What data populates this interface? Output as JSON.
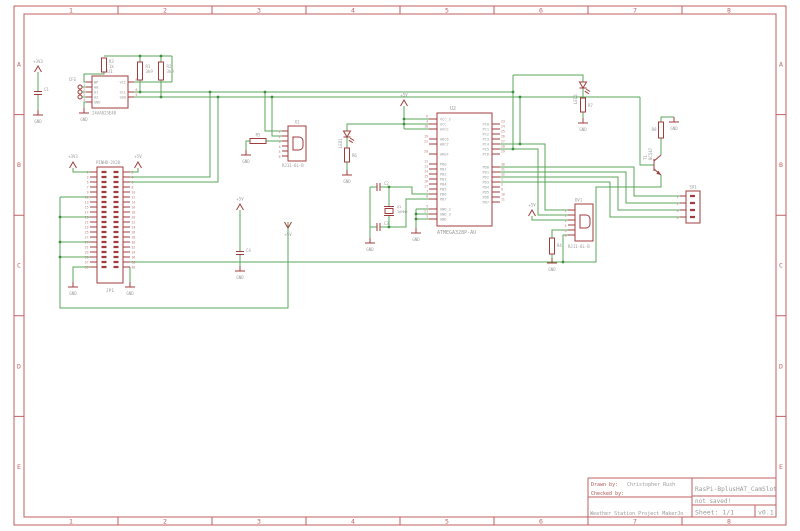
{
  "frame": {
    "columns": [
      "1",
      "2",
      "3",
      "4",
      "5",
      "6",
      "7",
      "8"
    ],
    "rows": [
      "A",
      "B",
      "C",
      "D",
      "E"
    ]
  },
  "title_block": {
    "drawn_by_label": "Drawn by:",
    "drawn_by_value": "Christopher Rush",
    "checked_by_label": "Checked by:",
    "checked_by_value": "",
    "project": "Weather Station Project MakerJo",
    "document_title": "RasPi-BplusHAT_CamSlot",
    "save_status": "not saved!",
    "sheet": "Sheet: 1/1",
    "version": "v0.1"
  },
  "net_labels": {
    "gnd": "GND",
    "p3v3": "+3V3",
    "p5v": "+5V"
  },
  "colors": {
    "wire": "#58a758",
    "symbol": "#a03c3c",
    "frame": "#c06060",
    "label": "#9a9a9a"
  },
  "components": {
    "u1": {
      "ref": "U1",
      "value": "24AA025E48",
      "pins_left": [
        "WP",
        "A0",
        "A1",
        "A2",
        "GND"
      ],
      "pin_numbers_left": [
        "7",
        "1",
        "2",
        "3",
        "4"
      ],
      "pins_right": [
        "VCC",
        "",
        "SCL",
        "SDA"
      ],
      "pin_numbers_right": [
        "8",
        "",
        "6",
        "5"
      ]
    },
    "cfg": {
      "ref": "CFG"
    },
    "c1": {
      "ref": "C1"
    },
    "c2": {
      "ref": "C2"
    },
    "c3": {
      "ref": "C3"
    },
    "c4": {
      "ref": "C4"
    },
    "r1": {
      "ref": "R1",
      "value": "3k9"
    },
    "r2": {
      "ref": "R2",
      "value": "3k9"
    },
    "r3": {
      "ref": "R3",
      "value": "1k"
    },
    "r4": {
      "ref": "R4"
    },
    "r5": {
      "ref": "R5"
    },
    "r6": {
      "ref": "R6"
    },
    "r7": {
      "ref": "R7"
    },
    "r8": {
      "ref": "R8"
    },
    "jp1": {
      "ref": "JP1",
      "value": "PINHD-2X20",
      "pin_numbers_left": [
        "1",
        "3",
        "5",
        "7",
        "9",
        "11",
        "13",
        "15",
        "17",
        "19",
        "21",
        "23",
        "25",
        "27",
        "29",
        "31",
        "33",
        "35",
        "37",
        "39"
      ],
      "pin_numbers_right": [
        "2",
        "4",
        "6",
        "8",
        "10",
        "12",
        "14",
        "16",
        "18",
        "20",
        "22",
        "24",
        "26",
        "28",
        "30",
        "32",
        "34",
        "36",
        "38",
        "40"
      ]
    },
    "x1": {
      "ref": "X1",
      "value": "RJ11-6L-B",
      "pin_numbers": [
        "1",
        "2",
        "3",
        "4",
        "5",
        "6"
      ]
    },
    "dv1": {
      "ref": "DV1",
      "value": "RJ11-6L-B",
      "pin_numbers": [
        "1",
        "2",
        "3",
        "4",
        "5",
        "6"
      ]
    },
    "sv1": {
      "ref": "SV1",
      "pin_numbers": [
        "1",
        "2",
        "3",
        "4"
      ]
    },
    "u2": {
      "ref": "U2",
      "value": "ATMEGA328P-AU",
      "pins_left": [
        "VCC_2",
        "VCC",
        "AVCC",
        "",
        "ADC6",
        "ADC7",
        "",
        "AREF",
        "",
        "PB0",
        "PB1",
        "PB2",
        "PB3",
        "PB4",
        "PB5",
        "PB6",
        "PB7",
        "",
        "GND_2",
        "GND_3",
        "GND"
      ],
      "pin_numbers_left": [
        "6",
        "4",
        "18",
        "",
        "19",
        "22",
        "",
        "20",
        "",
        "12",
        "13",
        "14",
        "15",
        "16",
        "17",
        "7",
        "8",
        "",
        "5",
        "21",
        "3"
      ],
      "pins_right_pc": [
        "PC0",
        "PC1",
        "PC2",
        "PC3",
        "PC4",
        "PC5",
        "PC6"
      ],
      "pin_numbers_right_pc": [
        "23",
        "24",
        "25",
        "26",
        "27",
        "28",
        "29"
      ],
      "pins_right_pd": [
        "PD0",
        "PD1",
        "PD2",
        "PD3",
        "PD4",
        "PD5",
        "PD6",
        "PD7"
      ],
      "pin_numbers_right_pd": [
        "30",
        "31",
        "32",
        "1",
        "2",
        "9",
        "10",
        "11"
      ]
    },
    "led1": {
      "ref": "LED1"
    },
    "led2": {
      "ref": "LED2"
    },
    "q1": {
      "ref": "Q1",
      "value": "16MHz"
    },
    "t1": {
      "ref": "T1",
      "value": "BC547"
    }
  }
}
